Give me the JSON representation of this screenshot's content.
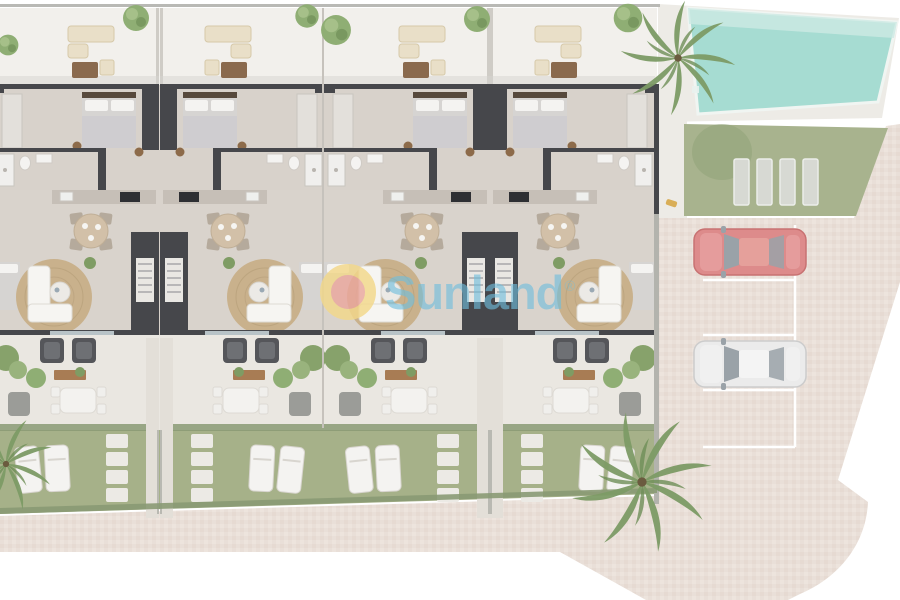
{
  "watermark": {
    "brand": "Sunland",
    "registered_mark": "®"
  },
  "colors": {
    "pavers": "#e9dfd8",
    "pavers_dark": "#e2d3c9",
    "pavers_light": "#f0e8e1",
    "pool": "#a6dcd2",
    "pool_light": "#cdeae3",
    "deck": "#edebe6",
    "lawn": "#a8b38e",
    "garden": "#a6b189",
    "hedge": "#8a9a74",
    "patio": "#f2f0ec",
    "floor": "#d8d2cb",
    "terrace": "#eae7e1",
    "wall": "#46474b",
    "rug": "#c9b18c",
    "wood": "#a87c54",
    "sofa_beige": "#e9dfc8",
    "white_furniture": "#f4f3f1",
    "armchair": "#55565a",
    "bed": "#d6d4d2",
    "pouf": "#8d6b4a",
    "tree": "#8fae74",
    "tree_dark": "#6f8f58",
    "palm": "#7d9b66",
    "red_car": "#dd8b8b",
    "red_car_roof": "#e5a09b",
    "car_glass": "#9aa2a8",
    "white_car": "#ebebeb",
    "white_car_roof": "#f4f4f4",
    "fence": "#b3b3ad",
    "marking": "#ffffff",
    "wm_blue": "#6fbedd",
    "logo_yellow": "#f3d88a",
    "logo_pink": "#eba79d"
  },
  "site": {
    "units": [
      {
        "id": "unit-1"
      },
      {
        "id": "unit-2"
      },
      {
        "id": "unit-3"
      },
      {
        "id": "unit-4"
      }
    ],
    "unit_features": [
      "roof-patio-lounge",
      "bedroom",
      "bathroom",
      "kitchen",
      "dining-area",
      "living-room",
      "staircase",
      "terrace",
      "private-garden"
    ],
    "garden": {
      "loungers_per_garden": 2,
      "stepping_stones_per_garden": 4
    },
    "amenities": {
      "swimming_pool": true,
      "communal_lawn": true,
      "sun_pads": 4,
      "palm_trees": 3
    },
    "parking": {
      "spaces": 4,
      "vehicles": [
        {
          "space": 1,
          "type": "car",
          "color_name": "red"
        },
        {
          "space": 3,
          "type": "car",
          "color_name": "white"
        }
      ],
      "empty_spaces": [
        2,
        4
      ]
    }
  }
}
